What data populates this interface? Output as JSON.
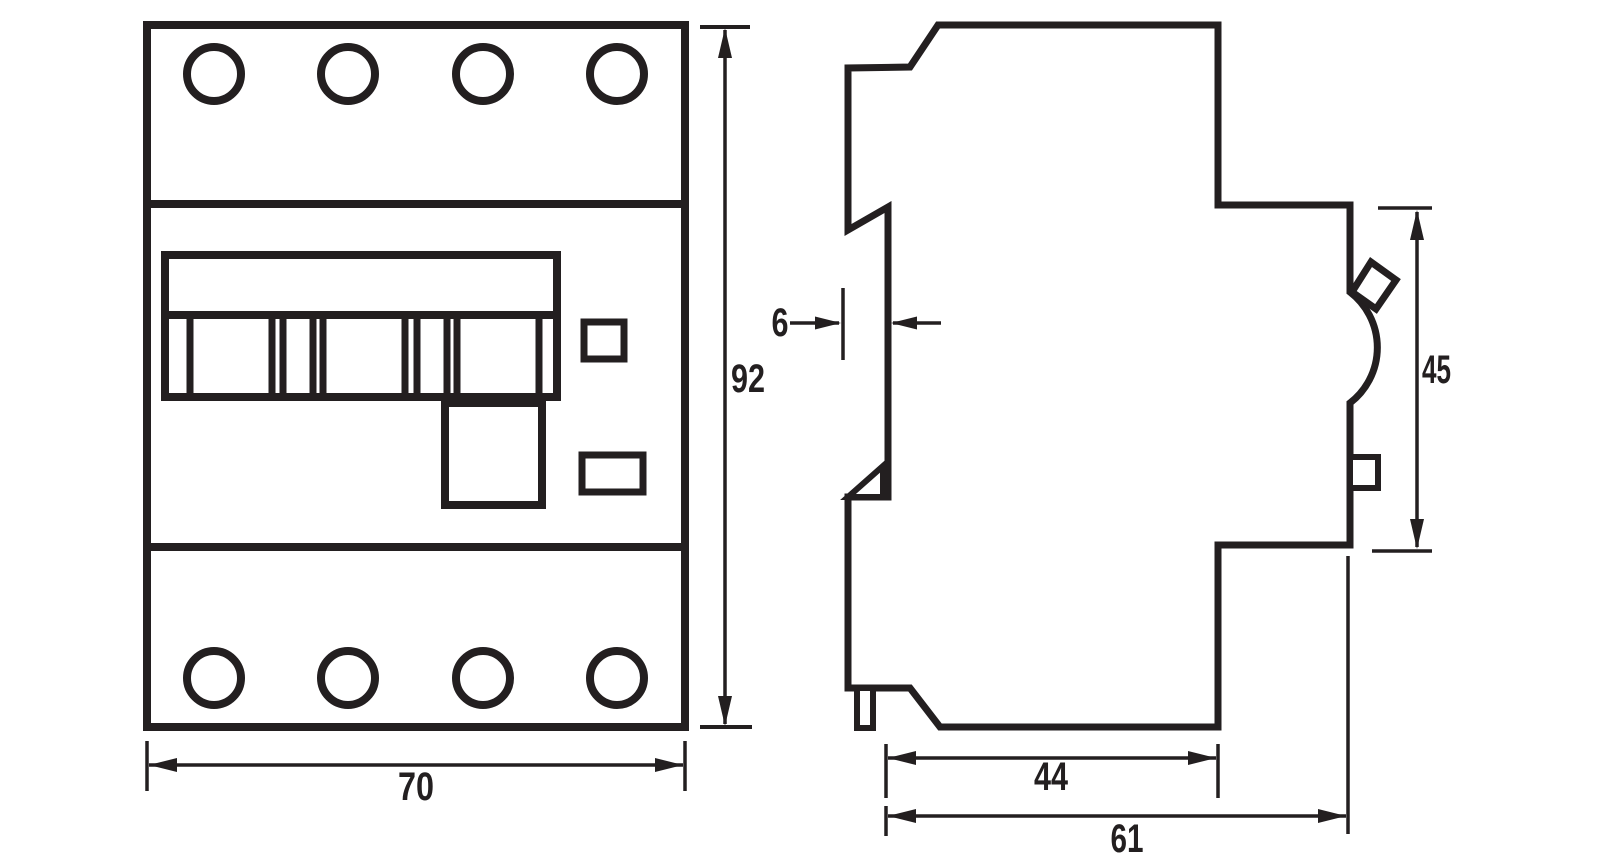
{
  "drawing": {
    "description": "Dimensional drawing of a 4-module DIN-rail circuit breaker, front view and side view",
    "colors": {
      "line": "#231f20",
      "background": "#ffffff"
    },
    "dimensions": {
      "front_width": "70",
      "front_height": "92",
      "rail_recess_depth": "6",
      "body_depth": "44",
      "overall_depth": "61",
      "front_section_height": "45"
    }
  }
}
